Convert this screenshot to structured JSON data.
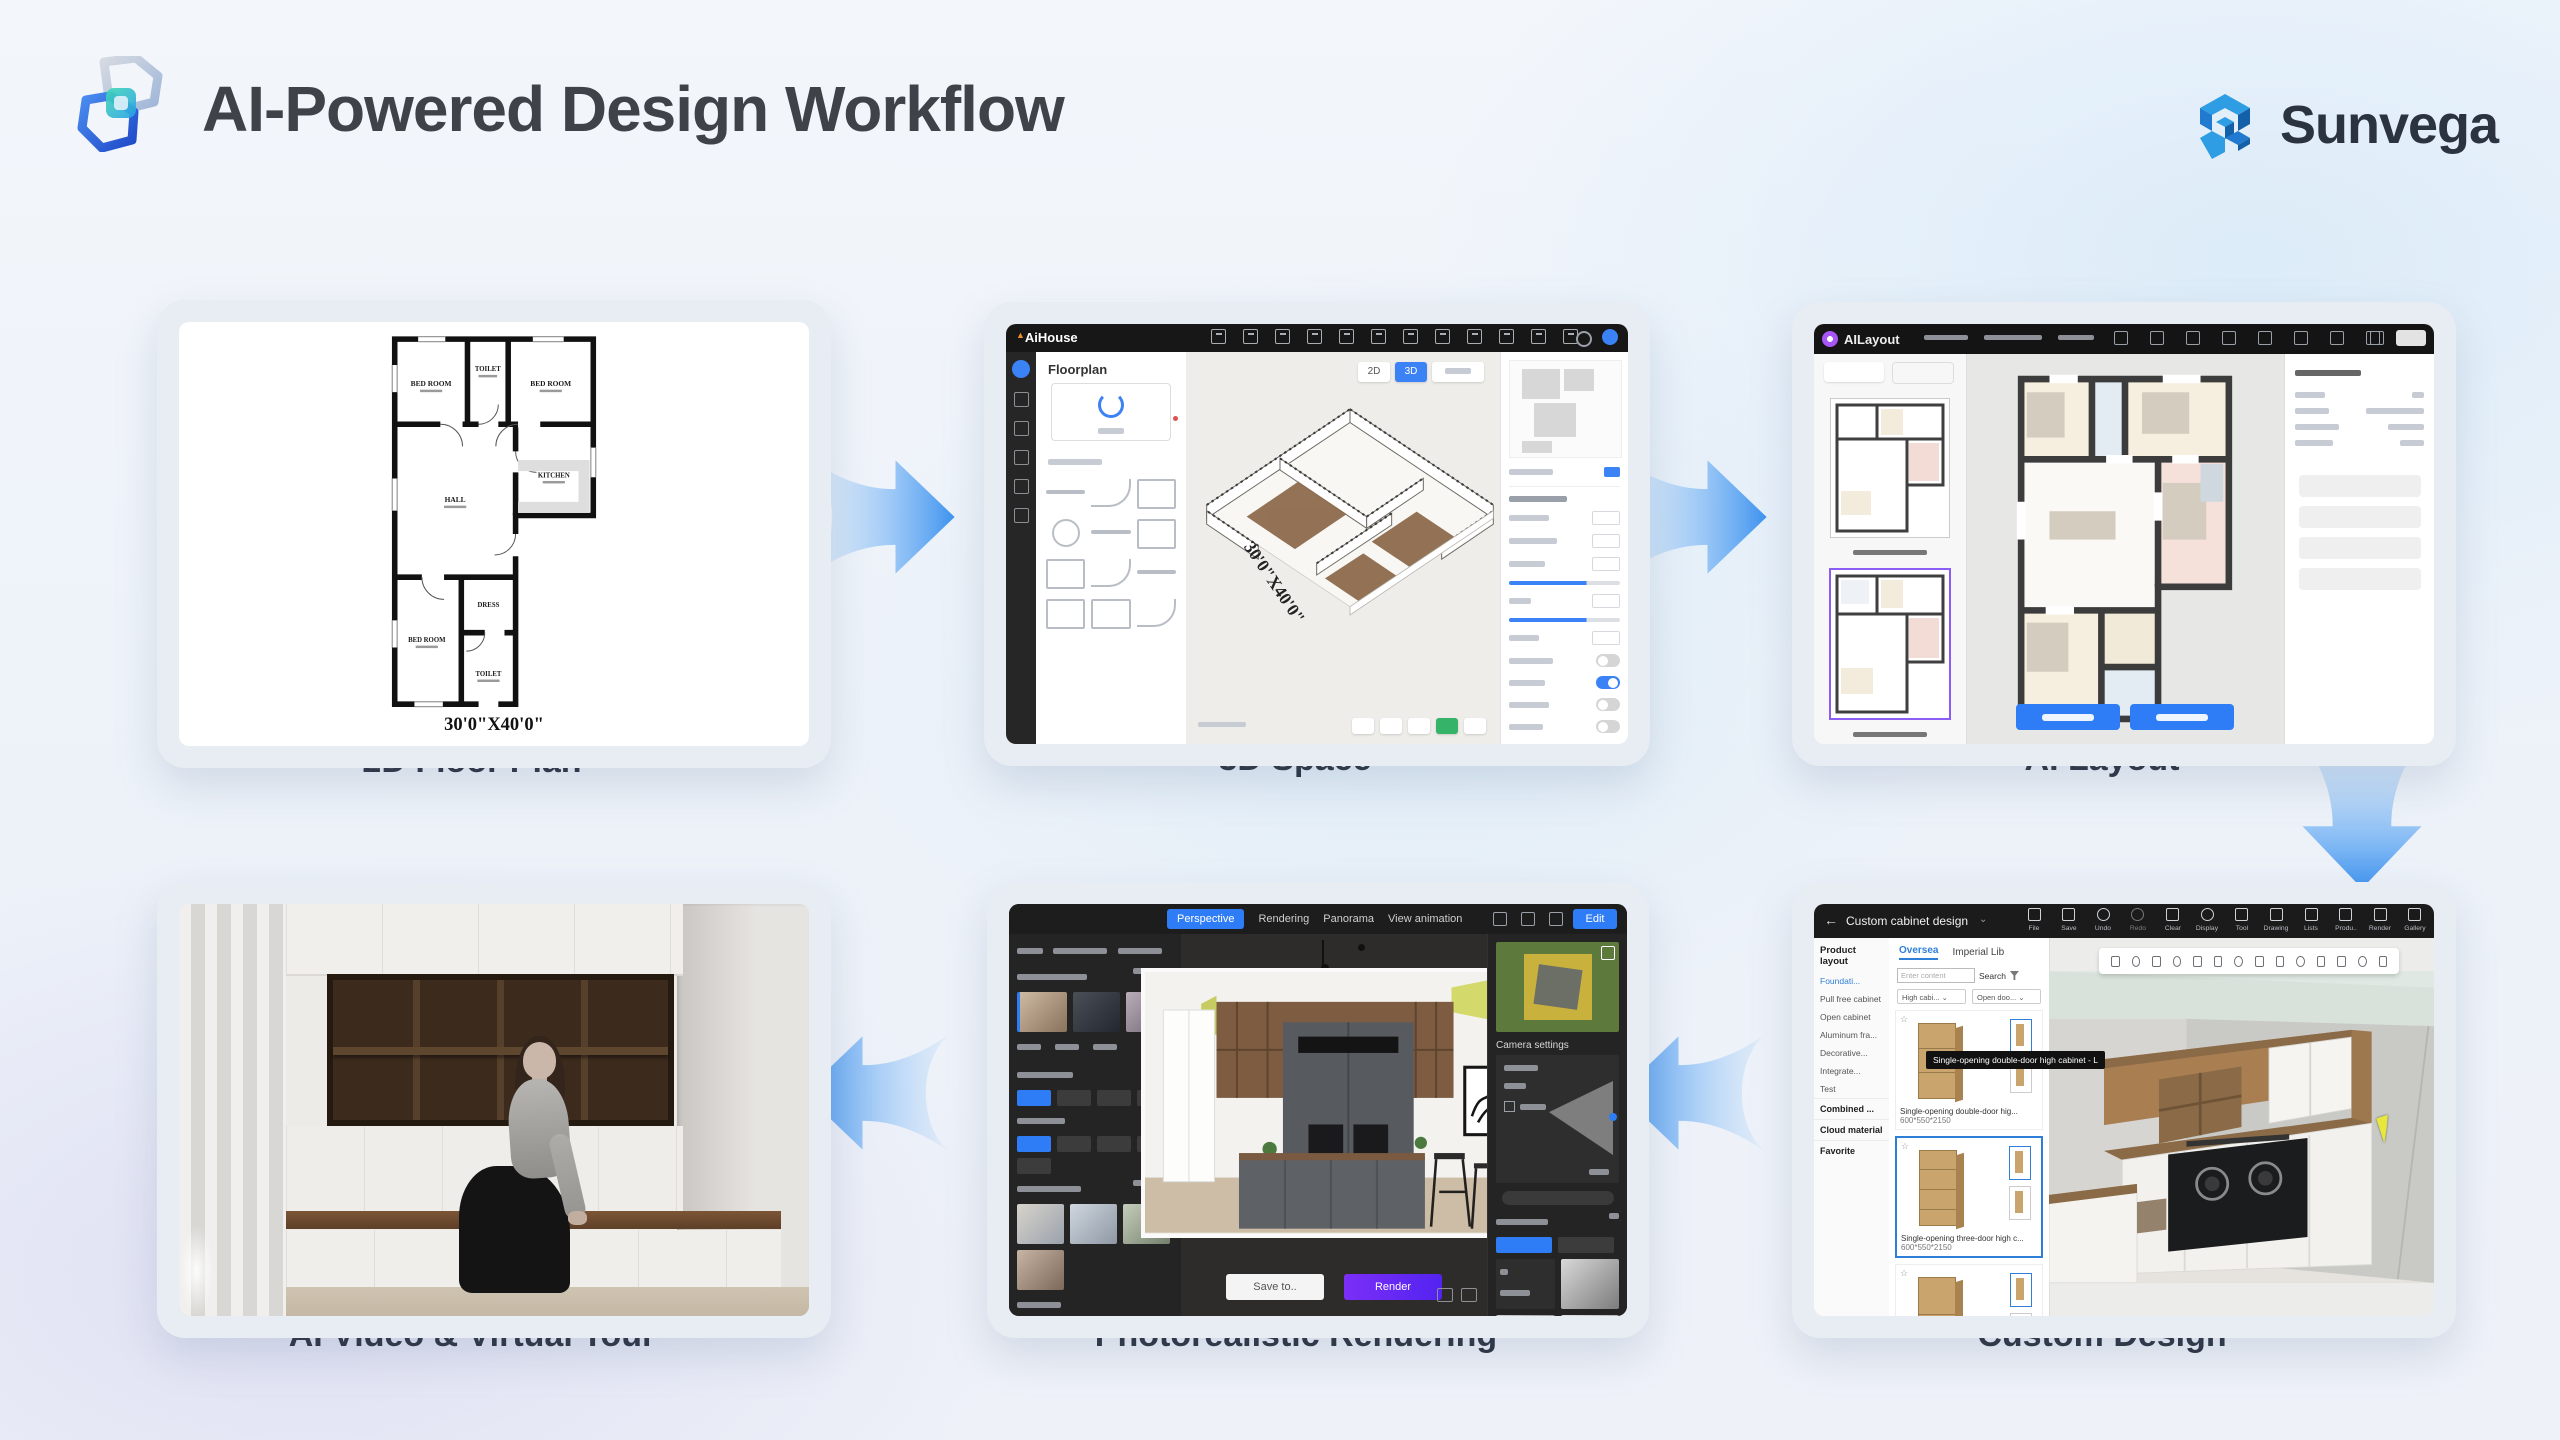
{
  "header": {
    "title": "AI-Powered Design Workflow",
    "brand": "Sunvega"
  },
  "steps": {
    "s1": "2D Floor Plan",
    "s2": "3D Space",
    "s3": "AI Layout",
    "s4": "AI Video & Virtual Tour",
    "s5": "Photorealistic Rendering",
    "s6": "Custom Design"
  },
  "floorplan2d": {
    "rooms": [
      "BED ROOM",
      "TOILET",
      "BED ROOM",
      "HALL",
      "KITCHEN",
      "BED ROOM",
      "DRESS",
      "TOILET"
    ],
    "dimension": "30'0\"X40'0\""
  },
  "aihouse": {
    "app": "AiHouse",
    "panel_title": "Floorplan",
    "dimension": "30'0\"X40'0\"",
    "view_2d": "2D",
    "view_3d": "3D"
  },
  "ailayout": {
    "app": "AILayout"
  },
  "render_app": {
    "tab_perspective": "Perspective",
    "tab_rendering": "Rendering",
    "tab_panorama": "Panorama",
    "tab_animation": "View animation",
    "edit_button": "Edit",
    "camera_settings": "Camera settings",
    "save_button": "Save to..",
    "render_button": "Render"
  },
  "cabinet_app": {
    "back_arrow": "←",
    "title": "Custom cabinet design",
    "caret": "⌄",
    "toolbar": [
      "File",
      "Save",
      "Undo",
      "Redo",
      "Clear",
      "Display",
      "Tool",
      "Drawing",
      "Lists",
      "Produ..",
      "Render",
      "Gallery"
    ],
    "sidebar_title": "Product layout",
    "sidebar_items": [
      "Foundati...",
      "Pull free cabinet",
      "Open cabinet",
      "Aluminum fra...",
      "Decorative...",
      "Integrate...",
      "Test"
    ],
    "sidebar_sections": [
      "Combined ...",
      "Cloud material",
      "Favorite"
    ],
    "tab_oversea": "Oversea",
    "tab_imperial": "Imperial Lib",
    "search_placeholder": "Enter content",
    "search_button": "Search",
    "filter_1": "High cabi...",
    "filter_2": "Open doo...",
    "star": "☆",
    "items": [
      {
        "name": "Single-opening double-door hig...",
        "size": "600*550*2150"
      },
      {
        "name": "Single-opening three-door high c...",
        "size": "600*550*2150"
      },
      {
        "name": "Single-opening single-door high c...",
        "size": "600*550*2150"
      }
    ],
    "tooltip": "Single-opening double-door high cabinet - L"
  },
  "colors": {
    "accent_blue": "#3e93f0",
    "button_blue": "#2f7df6",
    "render_purple": "#6d28f9",
    "brand_blue": "#1f7ad0"
  }
}
